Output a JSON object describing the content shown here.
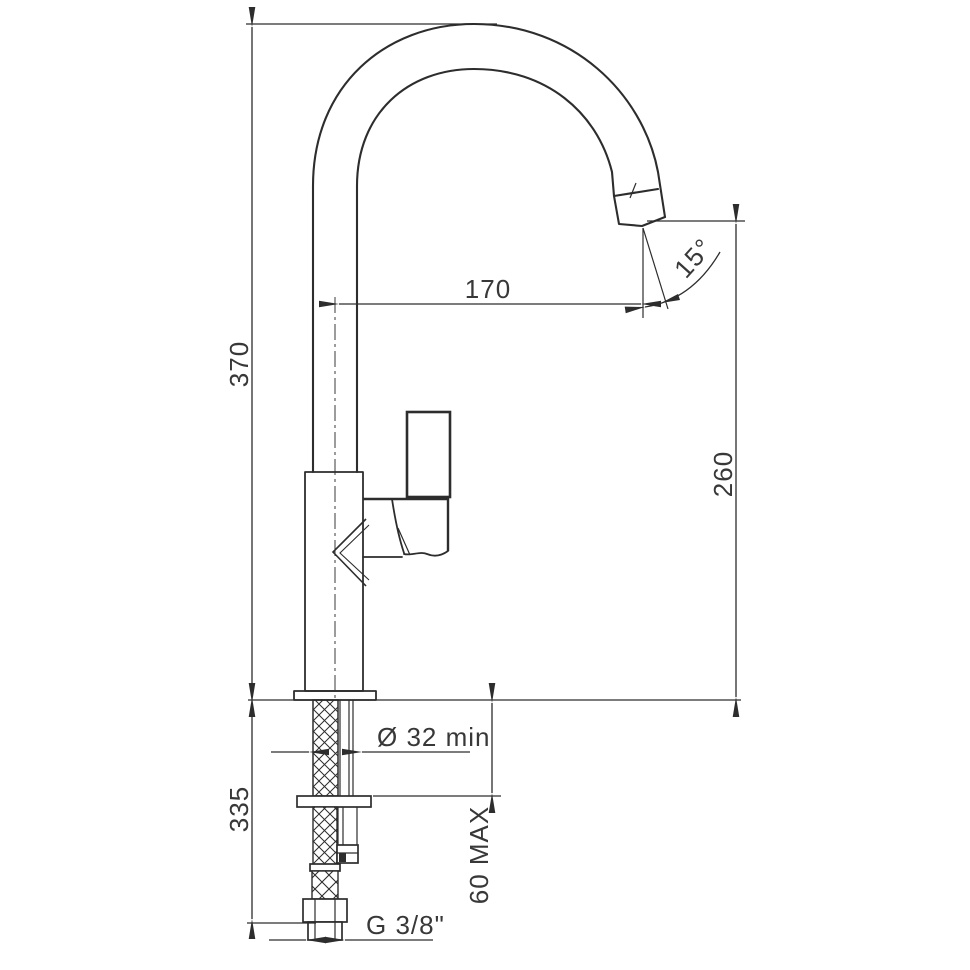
{
  "canvas": {
    "background": "#ffffff",
    "line_color": "#2d2d2d",
    "text_color": "#383838"
  },
  "diagram": {
    "kind": "technical-dimension-drawing",
    "subject": "single-lever kitchen mixer tap with high-arc gooseneck spout, side view with installation dimensions",
    "labels": {
      "overall_height": "370",
      "spout_reach": "170",
      "spout_angle": "15°",
      "outlet_height": "260",
      "under_counter_length": "335",
      "mounting_hole_diameter": "Ø 32 min",
      "max_counter_thickness": "60 MAX",
      "supply_thread": "G 3/8\""
    }
  }
}
